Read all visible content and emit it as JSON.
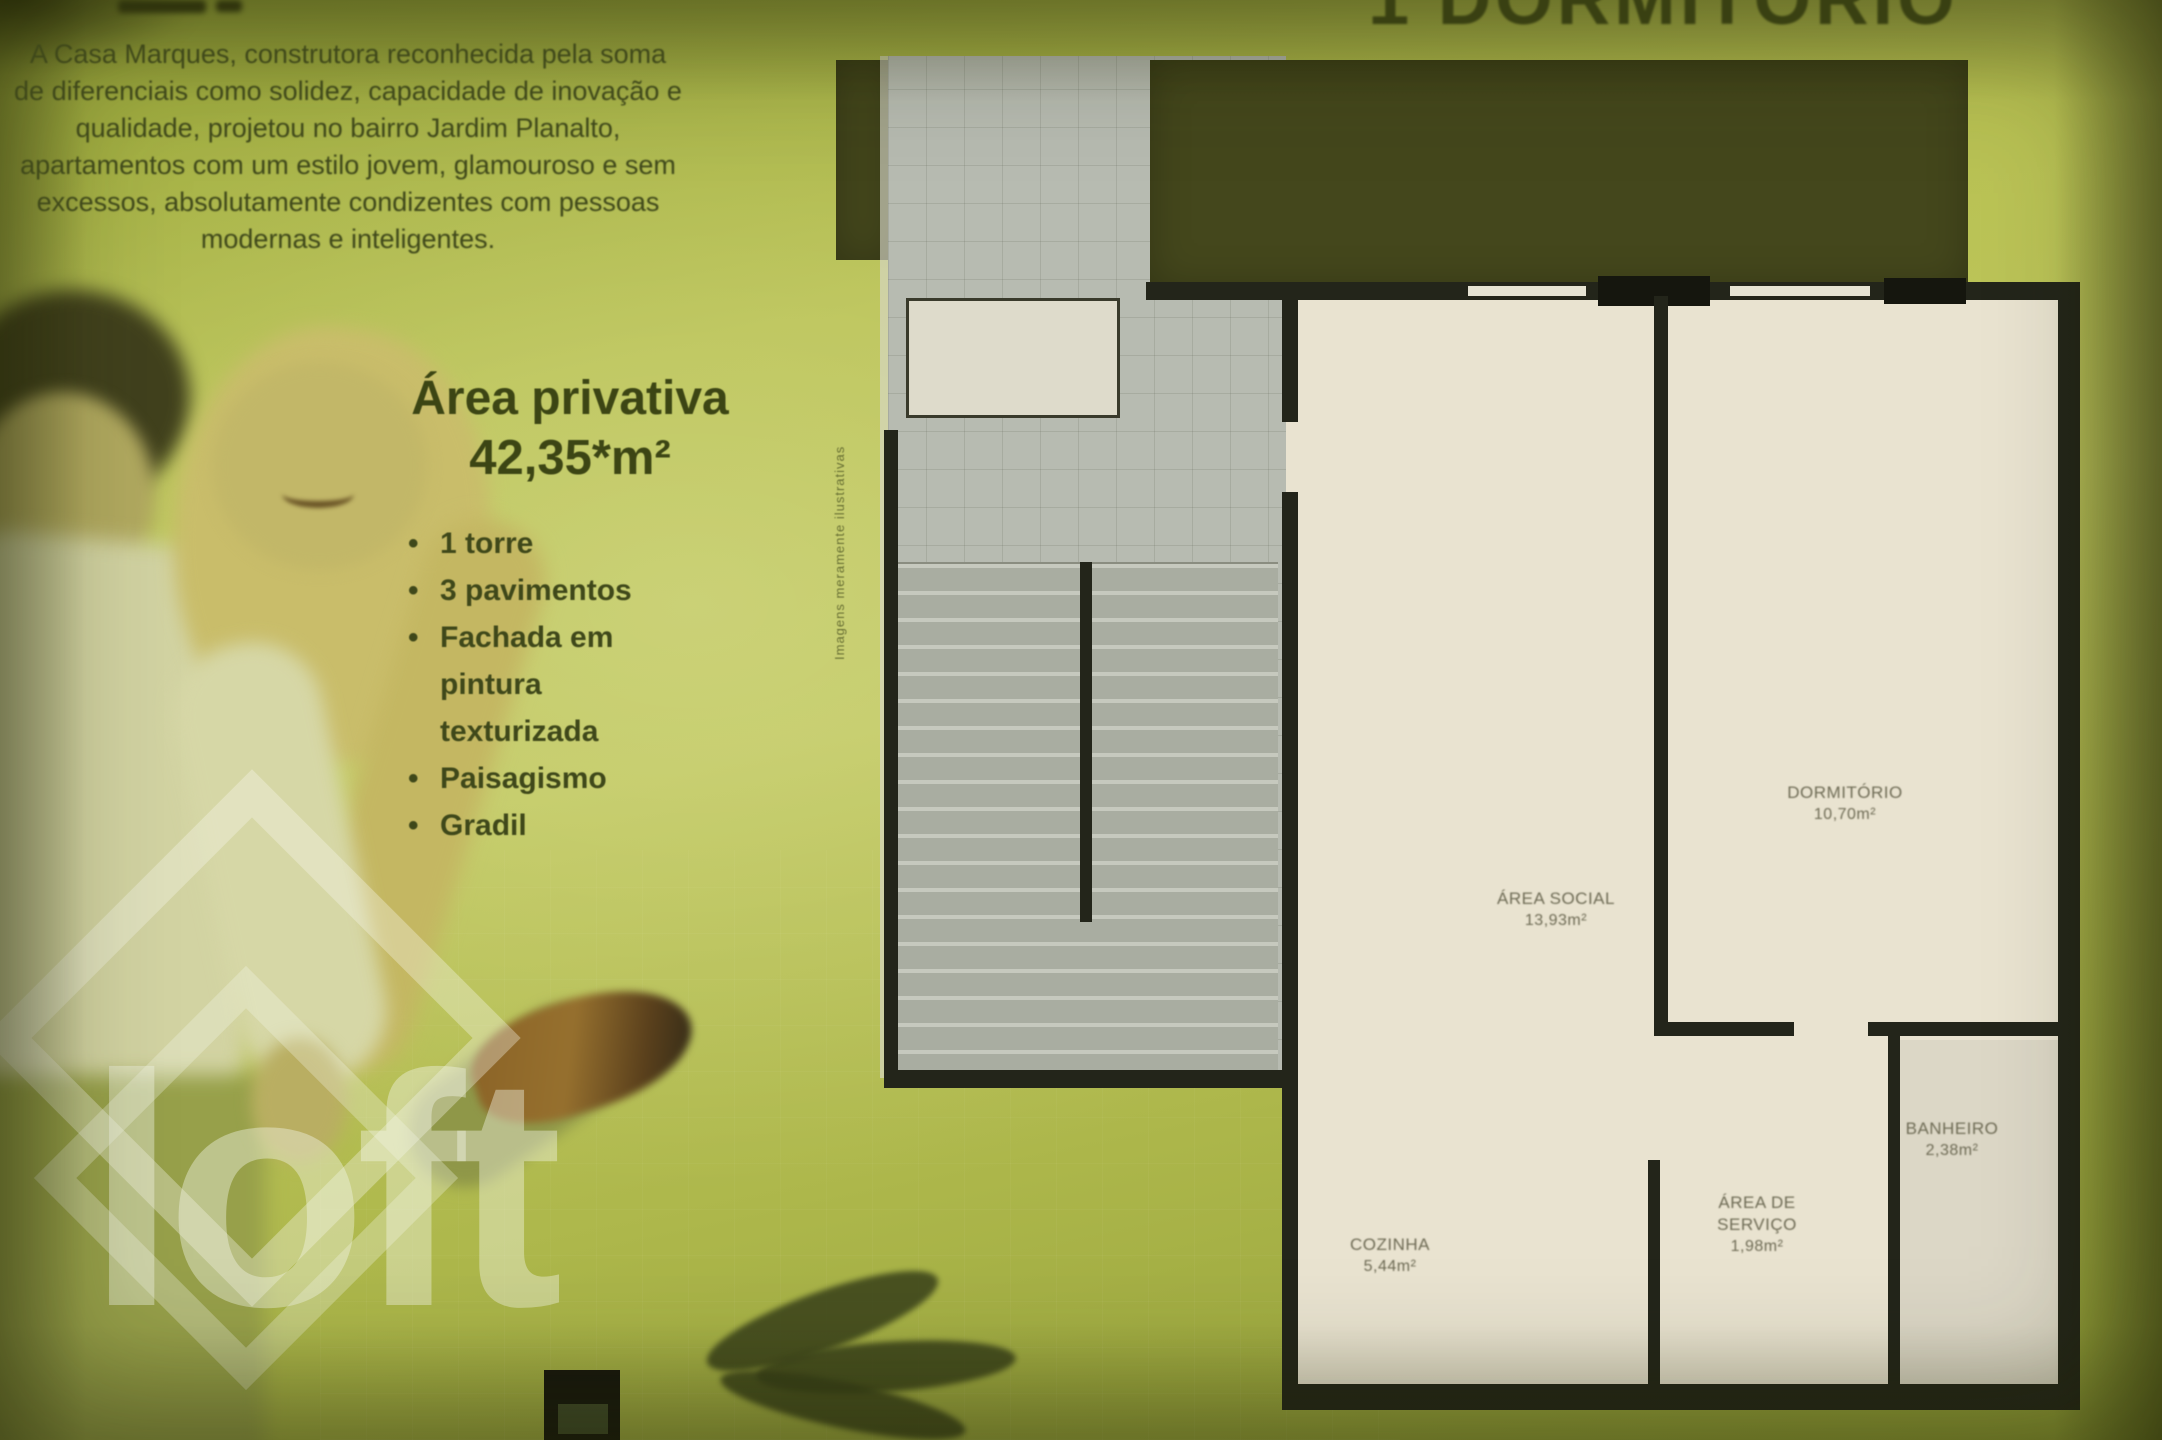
{
  "title": {
    "text": "1 DORMITÓRIO"
  },
  "intro": {
    "text": "A Casa Marques, construtora reconhecida pela soma de diferenciais como solidez, capacidade de inovação e qualidade, projetou no bairro Jardim Planalto, apartamentos com um estilo jovem, glamouroso e sem excessos, absolutamente condizentes com pessoas modernas e inteligentes."
  },
  "private_area": {
    "label": "Área privativa",
    "value": "42,35*m²"
  },
  "features": {
    "items": [
      "1 torre",
      "3 pavimentos",
      "Fachada em pintura texturizada",
      "Paisagismo",
      "Gradil"
    ],
    "bullet": "•"
  },
  "watermark": {
    "wordmark": "loft"
  },
  "floorplan": {
    "disclaimer": "Imagens meramente ilustrativas",
    "rooms": {
      "social": {
        "name": "ÁREA SOCIAL",
        "area": "13,93m²"
      },
      "bedroom": {
        "name": "DORMITÓRIO",
        "area": "10,70m²"
      },
      "kitchen": {
        "name": "COZINHA",
        "area": "5,44m²"
      },
      "service": {
        "name": "ÁREA DE SERVIÇO",
        "area": "1,98m²"
      },
      "bathroom": {
        "name": "BANHEIRO",
        "area": "2,38m²"
      }
    }
  },
  "colors": {
    "background": "#b7bf4e",
    "text": "#3f481a",
    "grass": "#44471c",
    "wall": "#23251a",
    "floor": "#e9e3d0",
    "counter": "#6d4b26",
    "watermark": "rgba(242,246,232,0.42)"
  }
}
